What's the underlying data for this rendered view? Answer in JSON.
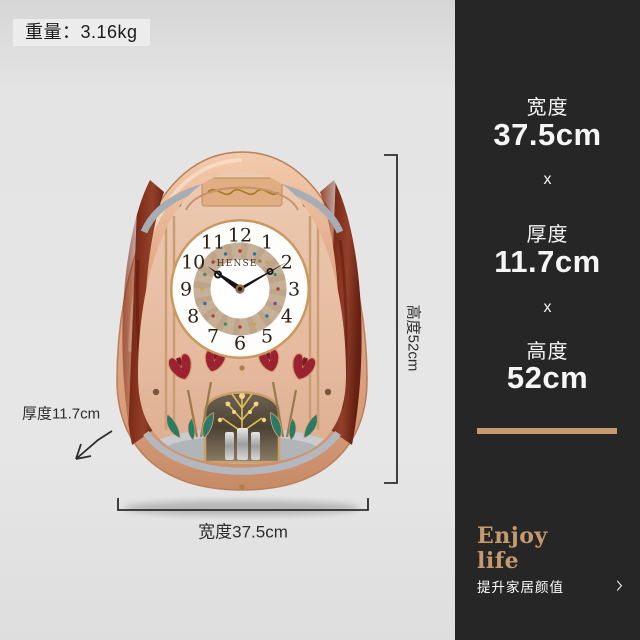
{
  "weight": {
    "label": "重量：3.16kg"
  },
  "specs": {
    "width_label": "宽度",
    "width_value": "37.5cm",
    "times1": "x",
    "depth_label": "厚度",
    "depth_value": "11.7cm",
    "times2": "x",
    "height_label": "高度",
    "height_value": "52cm"
  },
  "annotations": {
    "height_dim": "高度52cm",
    "width_dim": "宽度37.5cm",
    "depth_dim": "厚度11.7cm"
  },
  "clock": {
    "brand": "HENSE",
    "brand_reg": "®",
    "time_shown": "10:10",
    "numerals": [
      "12",
      "1",
      "2",
      "3",
      "4",
      "5",
      "6",
      "7",
      "8",
      "9",
      "10",
      "11"
    ]
  },
  "footer": {
    "tagline_en_line1": "Enjoy",
    "tagline_en_line2": "life",
    "tagline_cn": "提升家居颜值",
    "chevron": "›"
  },
  "colors": {
    "page_bg": "#e5e5e5",
    "panel_bg": "#262626",
    "accent_gold": "#c79a6d",
    "rose_gold": "#e3ae8c",
    "wood": "#82301c"
  }
}
